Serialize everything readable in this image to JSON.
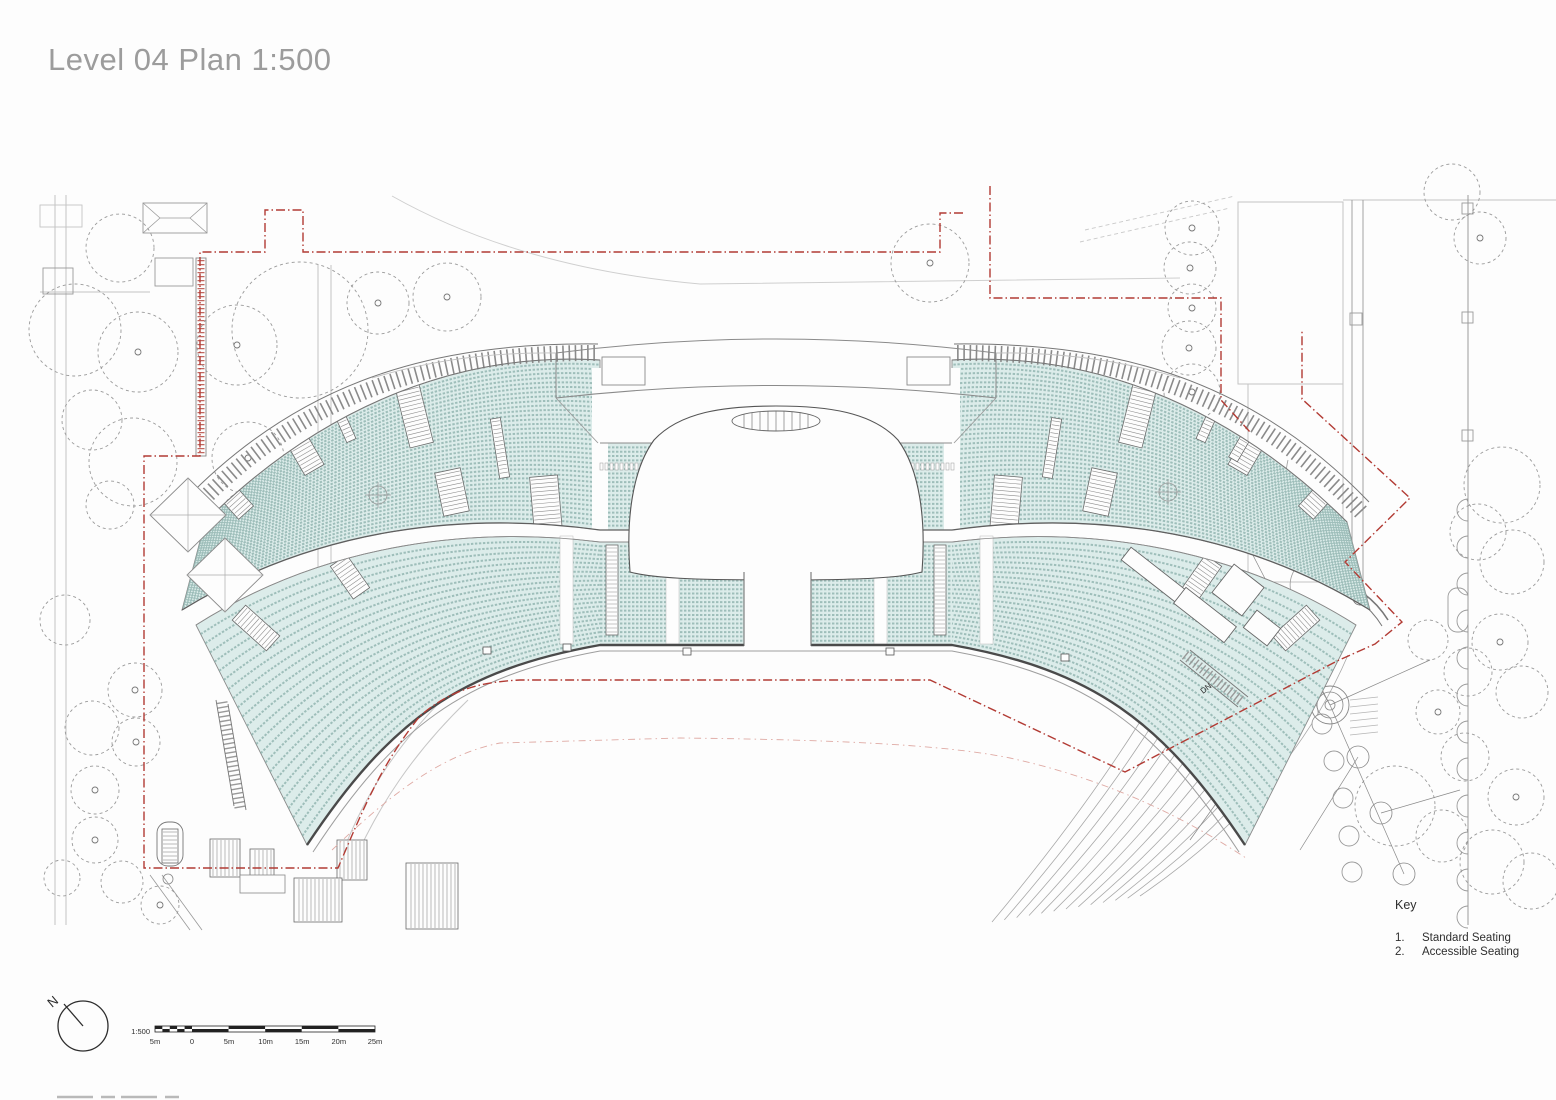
{
  "title": "Level 04 Plan 1:500",
  "key": {
    "heading": "Key",
    "items": [
      {
        "num": "1.",
        "label": "Standard Seating"
      },
      {
        "num": "2.",
        "label": "Accessible Seating"
      }
    ]
  },
  "north_arrow": {
    "label": "N"
  },
  "scale_bar": {
    "ratio_label": "1:500",
    "tick_labels": [
      "5m",
      "0",
      "5m",
      "10m",
      "15m",
      "20m",
      "25m"
    ]
  },
  "plan_annotations": {
    "stair_direction_label": "DN"
  },
  "colors": {
    "seating_fill": "#dcecea",
    "seating_row_line": "#8fb3ae",
    "boundary_red": "#b23b34",
    "boundary_red_faint": "#dfaaa4",
    "context_gray": "#9a9a9a",
    "structure_dark": "#4a4a4a",
    "structure_mid": "#6e6e6e",
    "title_gray": "#9c9c9c",
    "text_dark": "#2e2e2e"
  }
}
